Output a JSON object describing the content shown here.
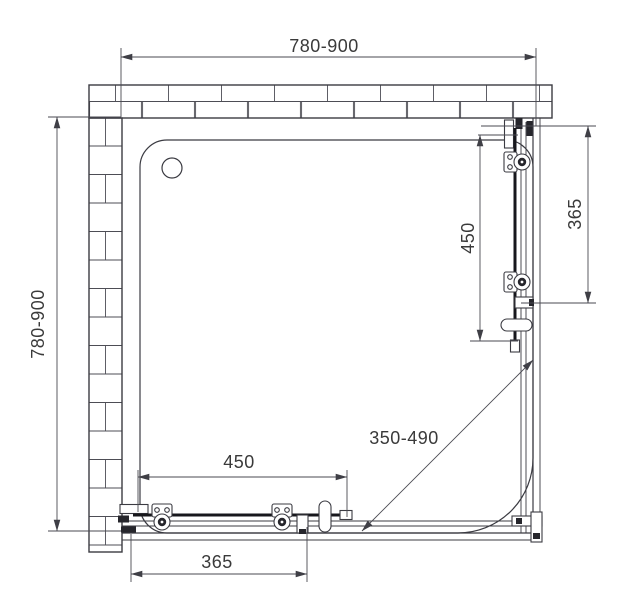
{
  "drawing": {
    "colors": {
      "background": "#ffffff",
      "lines": "#3b3b42",
      "text": "#3a3a3a"
    },
    "dimensions": {
      "top_width": "780-900",
      "left_depth": "780-900",
      "right_fixed_panel": "365",
      "right_door": "450",
      "corner_opening": "350-490",
      "bottom_door": "450",
      "bottom_fixed_panel": "365"
    }
  }
}
